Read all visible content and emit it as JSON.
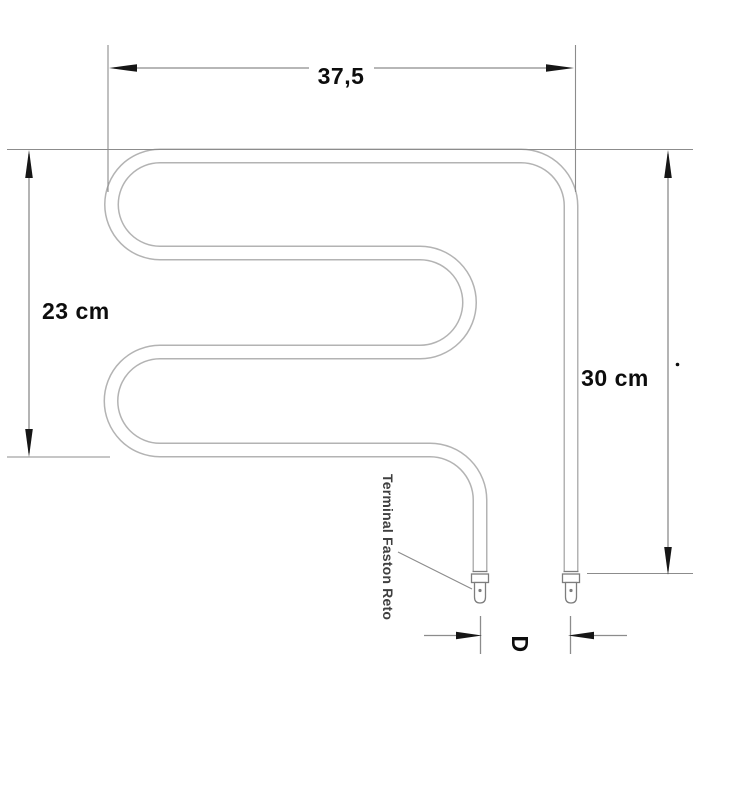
{
  "diagram": {
    "kind": "heating-element-technical-drawing",
    "dimensions": {
      "top_width": "37,5",
      "left_height": "23 cm",
      "right_height": "30 cm",
      "terminal_spacing": "D"
    },
    "labels": {
      "terminal": "Terminal Faston Reto"
    },
    "colors": {
      "background": "#ffffff",
      "tube_outline": "#b3b3b3",
      "terminal_outline": "#7d7d7d",
      "dimension_line": "#8c8c8c",
      "arrow_fill": "#161616",
      "dimension_text": "#0d0d0d",
      "terminal_text": "#3f3f3f"
    }
  }
}
